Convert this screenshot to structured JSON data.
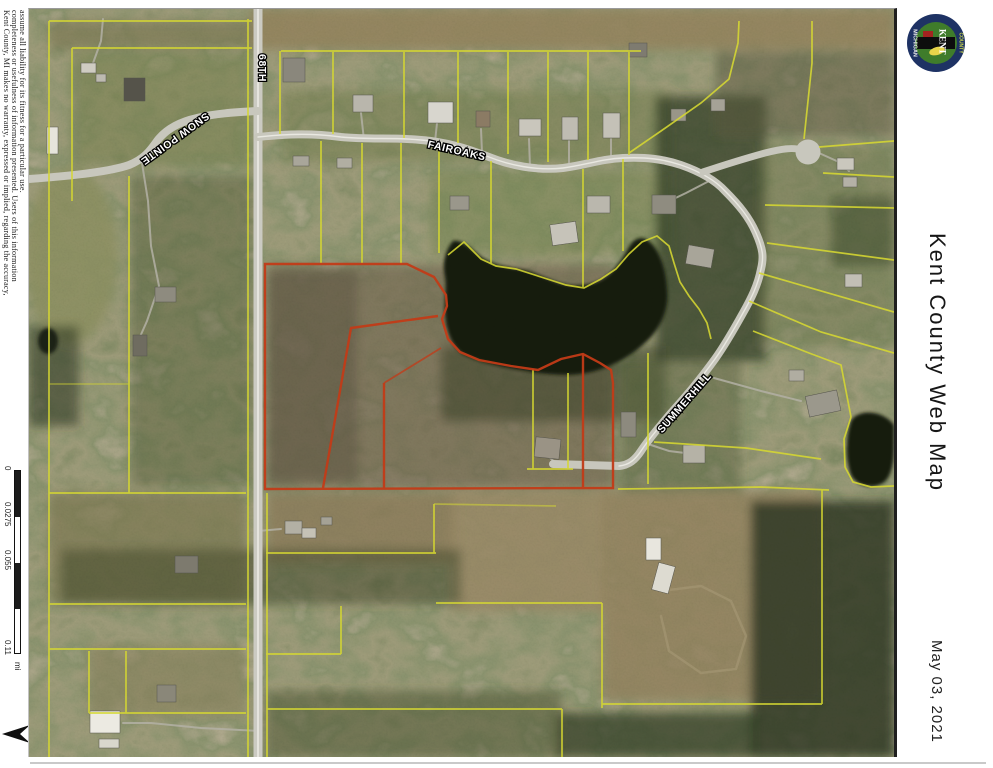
{
  "title_panel": {
    "title": "Kent County Web Map",
    "date": "May 03, 2021"
  },
  "logo": {
    "name": "kent-county-michigan-seal",
    "banner_text": "KENT",
    "ring_left_text": "MICHIGAN",
    "ring_right_text": "COUNTY"
  },
  "disclaimer": {
    "lines": [
      "Kent County, MI makes no warranty, expressed or implied, regarding the accuracy,",
      "completeness or usefulness of information presented.  Users of this information",
      "assume all liability for its fitness for a particular use."
    ]
  },
  "scale_bar": {
    "tick_labels": [
      "0",
      "0.0275",
      "0.055",
      "0.11"
    ],
    "unit": "mi"
  },
  "north_arrow_label": "N",
  "map": {
    "type": "aerial-parcel-map",
    "road_labels": [
      {
        "id": "68th",
        "text": "68TH"
      },
      {
        "id": "snow-pointe",
        "text": "SNOW POINTE"
      },
      {
        "id": "fairoaks",
        "text": "FAIROAKS"
      },
      {
        "id": "summerhill",
        "text": "SUMMERHILL"
      }
    ],
    "colors": {
      "parcel_line": "#d6d832",
      "highlight_parcel": "#c23b18",
      "road": "#c8c7bd",
      "water": "#131b0e",
      "label_fill": "#ffffff",
      "label_outline": "#000000"
    }
  }
}
